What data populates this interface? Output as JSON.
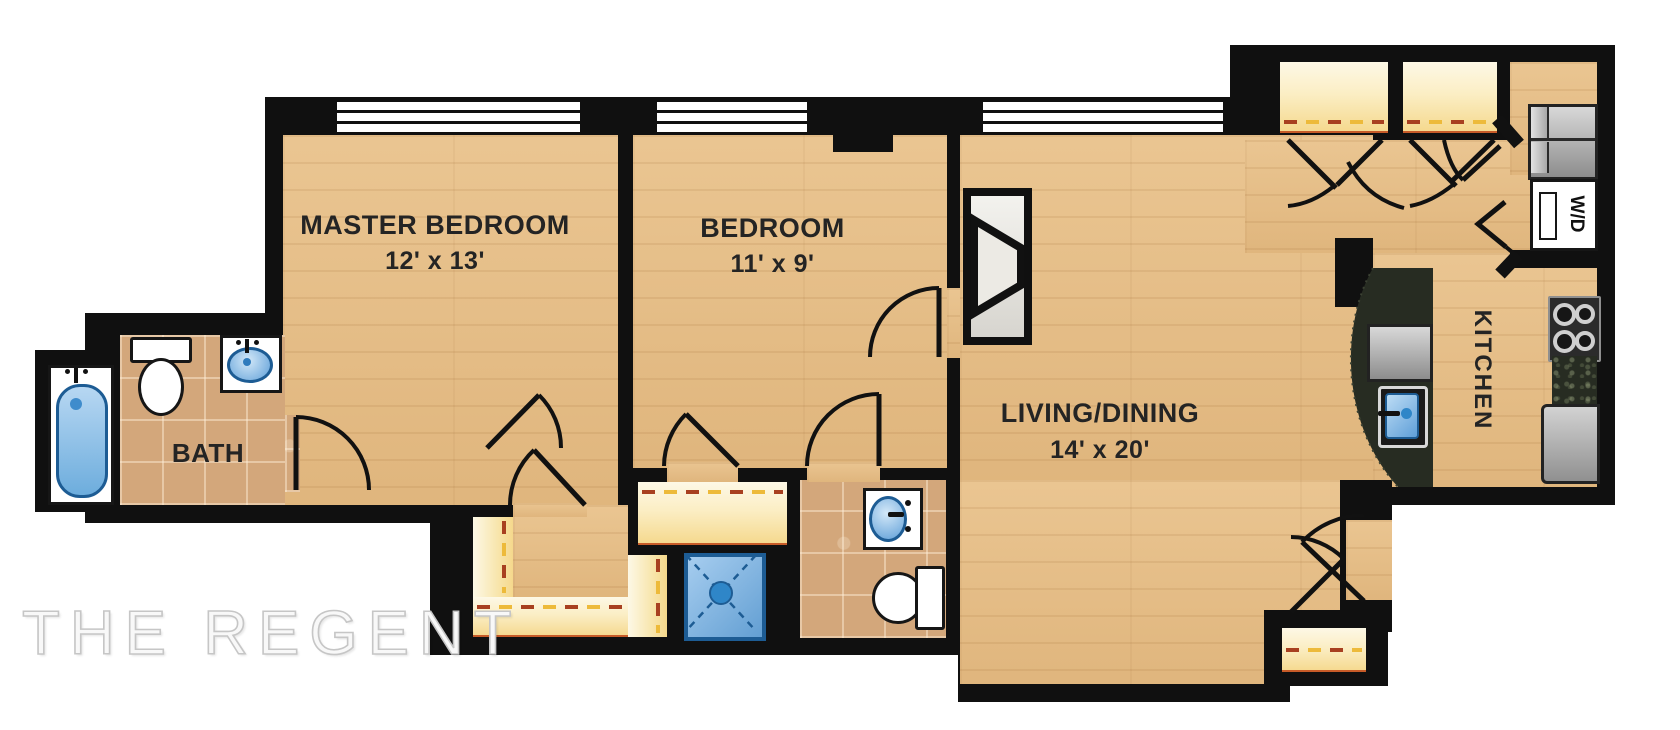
{
  "plan": {
    "watermark": "THE REGENT",
    "rooms": [
      {
        "label": "MASTER BEDROOM",
        "dims": "12' x 13'"
      },
      {
        "label": "BEDROOM",
        "dims": "11' x 9'"
      },
      {
        "label": "LIVING/DINING",
        "dims": "14' x 20'"
      },
      {
        "label": "BATH"
      },
      {
        "label": "KITCHEN"
      }
    ],
    "labels": {
      "washer_dryer": "W/D"
    },
    "colors": {
      "wall": "#101010",
      "wood_floor": "#e5bc84",
      "tile_floor": "#d3a77b",
      "closet_floor": "#f8e9b8",
      "fixture_blue": "#5f9fd8",
      "granite": "#272c22",
      "appliance_gray": "#b5b5b5"
    }
  }
}
